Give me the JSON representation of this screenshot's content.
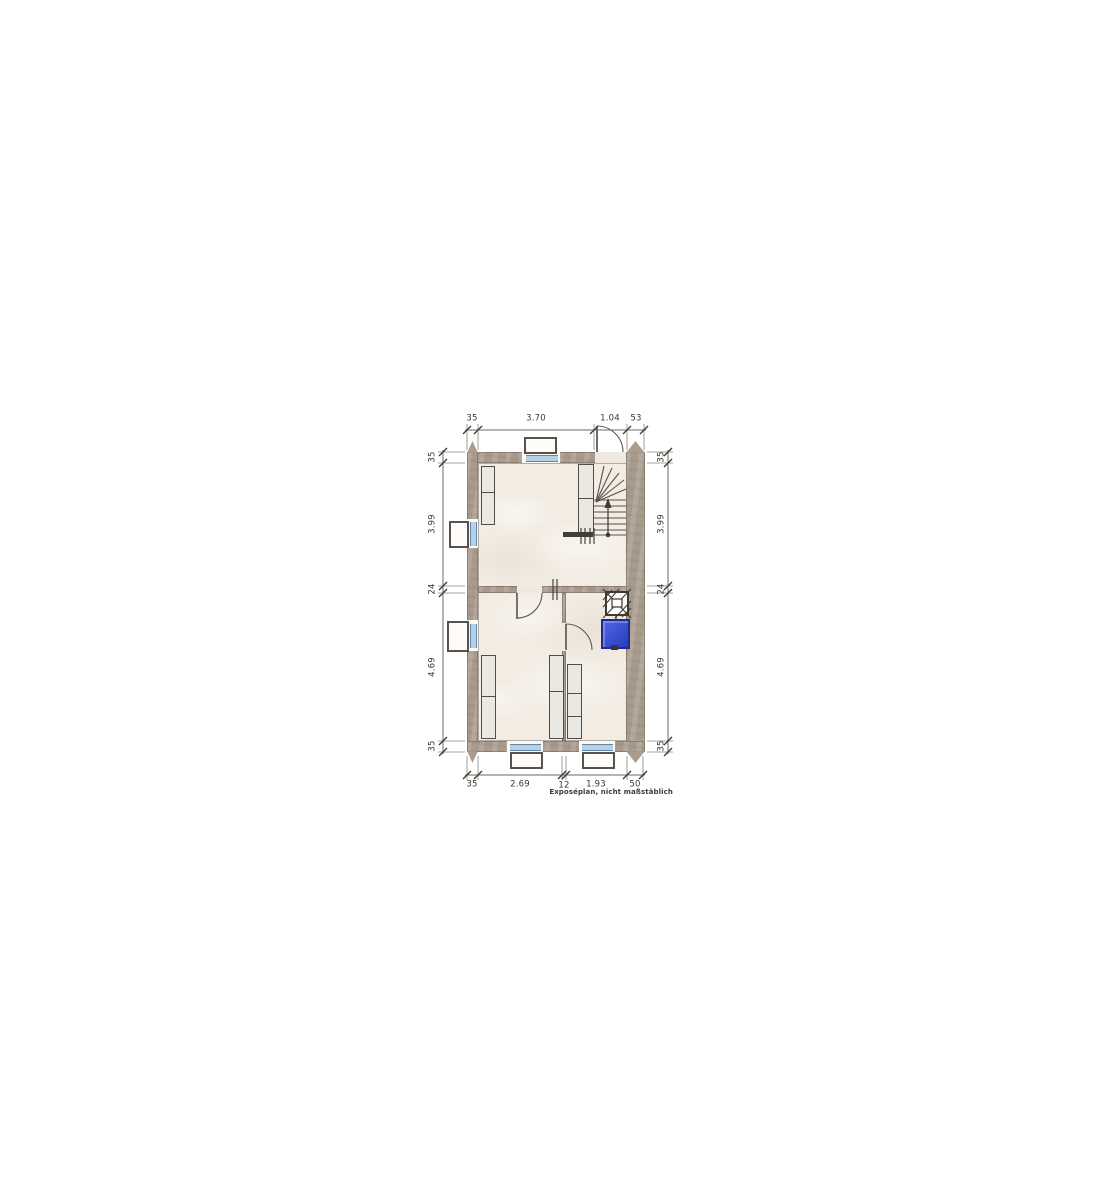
{
  "dimensions": {
    "top": [
      "35",
      "3.70",
      "1.04",
      "53"
    ],
    "bottom": [
      "35",
      "2.69",
      "12",
      "1.93",
      "50"
    ],
    "left": [
      "35",
      "3.99",
      "24",
      "4.69",
      "35"
    ],
    "right": [
      "35",
      "3.99",
      "24",
      "4.69",
      "35"
    ]
  },
  "annotations": {
    "disclaimer": "Exposéplan, nicht maßstäblich"
  },
  "icons": {
    "staircase": "winder-staircase-with-walkline-arrow",
    "chimney": "chimney-flue-crosshatch",
    "water_fixture": "washbasin-blue",
    "doors": "door-swing-arc",
    "windows": "window-with-exterior-sill-box",
    "closets": "built-in-wardrobe"
  },
  "colors": {
    "wall": "#a89a8c",
    "floor": "#f2ece3",
    "glazing": "#8fb0cc",
    "fixture": "#e9e8e2",
    "water": "#3a4ed0",
    "line": "#4c473f"
  }
}
